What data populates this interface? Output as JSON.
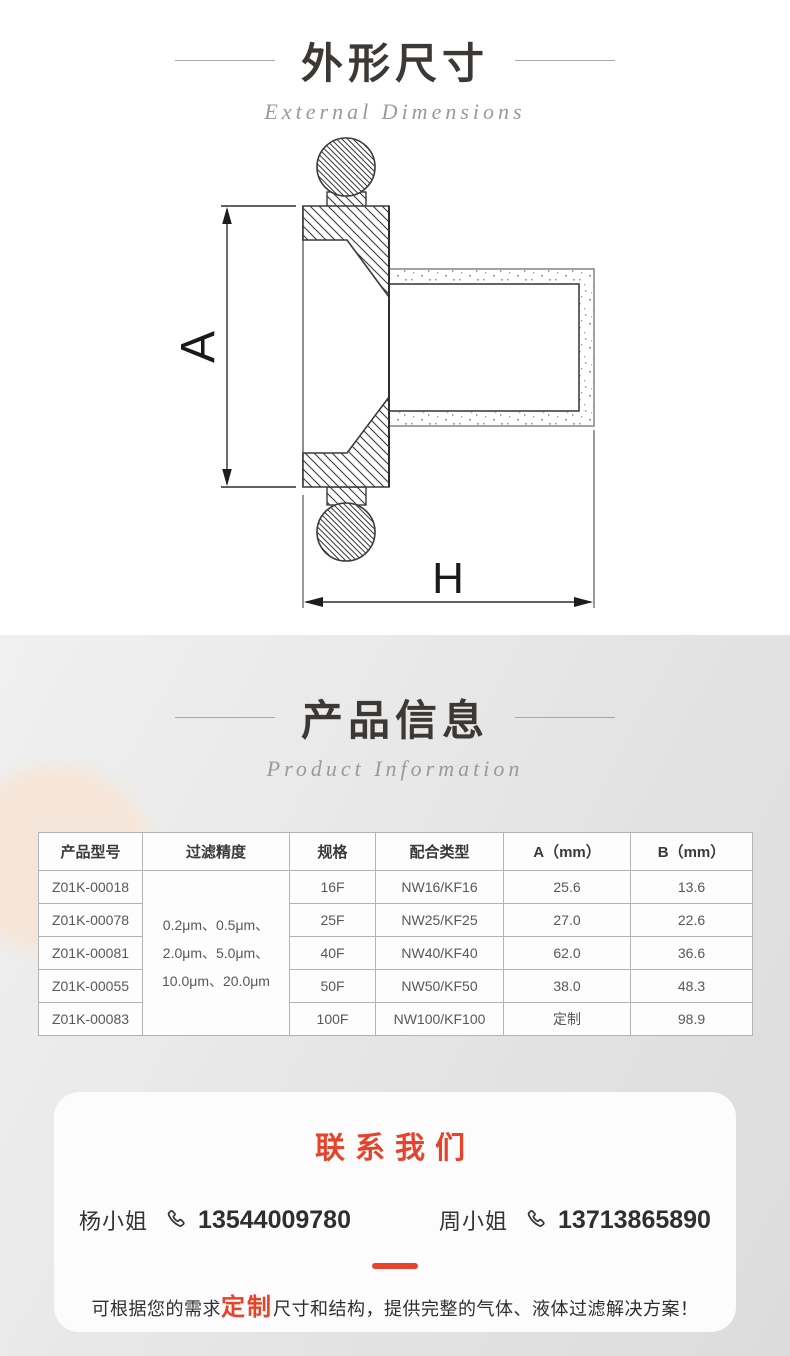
{
  "section_dimensions": {
    "title": "外形尺寸",
    "subtitle": "External Dimensions",
    "labels": {
      "a": "A",
      "h": "H"
    }
  },
  "section_info": {
    "title": "产品信息",
    "subtitle": "Product Information"
  },
  "table": {
    "headers": [
      "产品型号",
      "过滤精度",
      "规格",
      "配合类型",
      "A（mm）",
      "B（mm）"
    ],
    "precision_lines": [
      "0.2μm、0.5μm、",
      "2.0μm、5.0μm、",
      "10.0μm、20.0μm"
    ],
    "rows": [
      {
        "model": "Z01K-00018",
        "spec": "16F",
        "type": "NW16/KF16",
        "a": "25.6",
        "b": "13.6"
      },
      {
        "model": "Z01K-00078",
        "spec": "25F",
        "type": "NW25/KF25",
        "a": "27.0",
        "b": "22.6"
      },
      {
        "model": "Z01K-00081",
        "spec": "40F",
        "type": "NW40/KF40",
        "a": "62.0",
        "b": "36.6"
      },
      {
        "model": "Z01K-00055",
        "spec": "50F",
        "type": "NW50/KF50",
        "a": "38.0",
        "b": "48.3"
      },
      {
        "model": "Z01K-00083",
        "spec": "100F",
        "type": "NW100/KF100",
        "a": "定制",
        "b": "98.9"
      }
    ]
  },
  "contact": {
    "title": "联系我们",
    "contacts": [
      {
        "name": "杨小姐",
        "phone": "13544009780"
      },
      {
        "name": "周小姐",
        "phone": "13713865890"
      }
    ],
    "note_prefix": "可根据您的需求",
    "note_highlight": "定制",
    "note_suffix": "尺寸和结构，提供完整的气体、液体过滤解决方案！"
  },
  "colors": {
    "accent_red": "#e8432a",
    "title_dark": "#3c3835",
    "section_bg": "#e5e5e5"
  }
}
